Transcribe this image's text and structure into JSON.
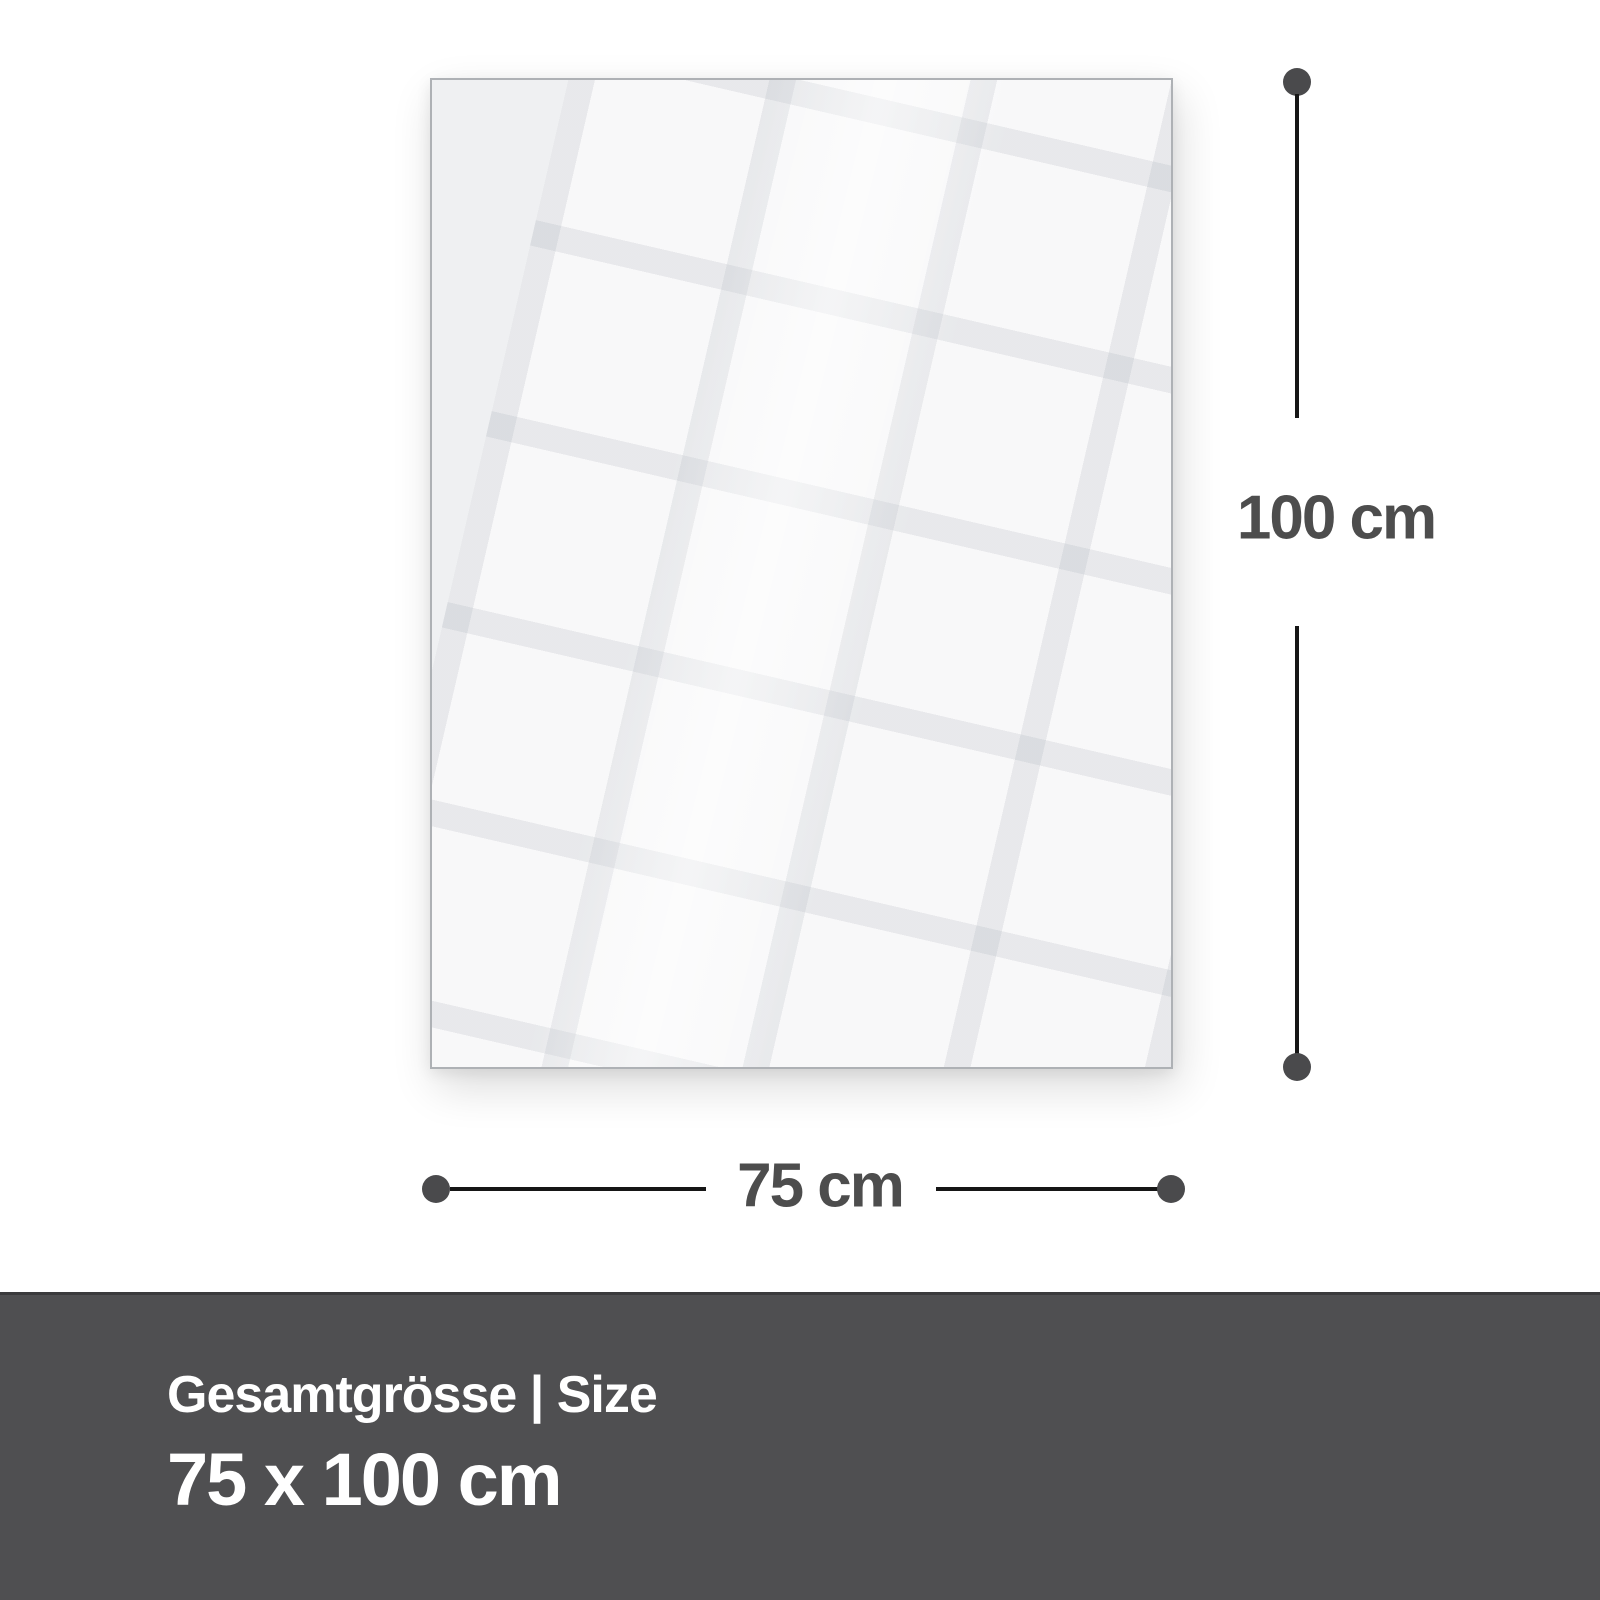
{
  "diagram": {
    "height_label": "100 cm",
    "width_label": "75 cm"
  },
  "footer": {
    "title": "Gesamtgrösse | Size",
    "size": "75 x 100 cm"
  },
  "colors": {
    "background": "#ffffff",
    "panel_fill": "#eff0f2",
    "panel_border": "#aeb1b5",
    "dimension_line": "#161616",
    "dimension_dot": "#4a4a4c",
    "dimension_text": "#4d4d4d",
    "footer_background": "#4f4f51",
    "footer_text": "#ffffff"
  }
}
